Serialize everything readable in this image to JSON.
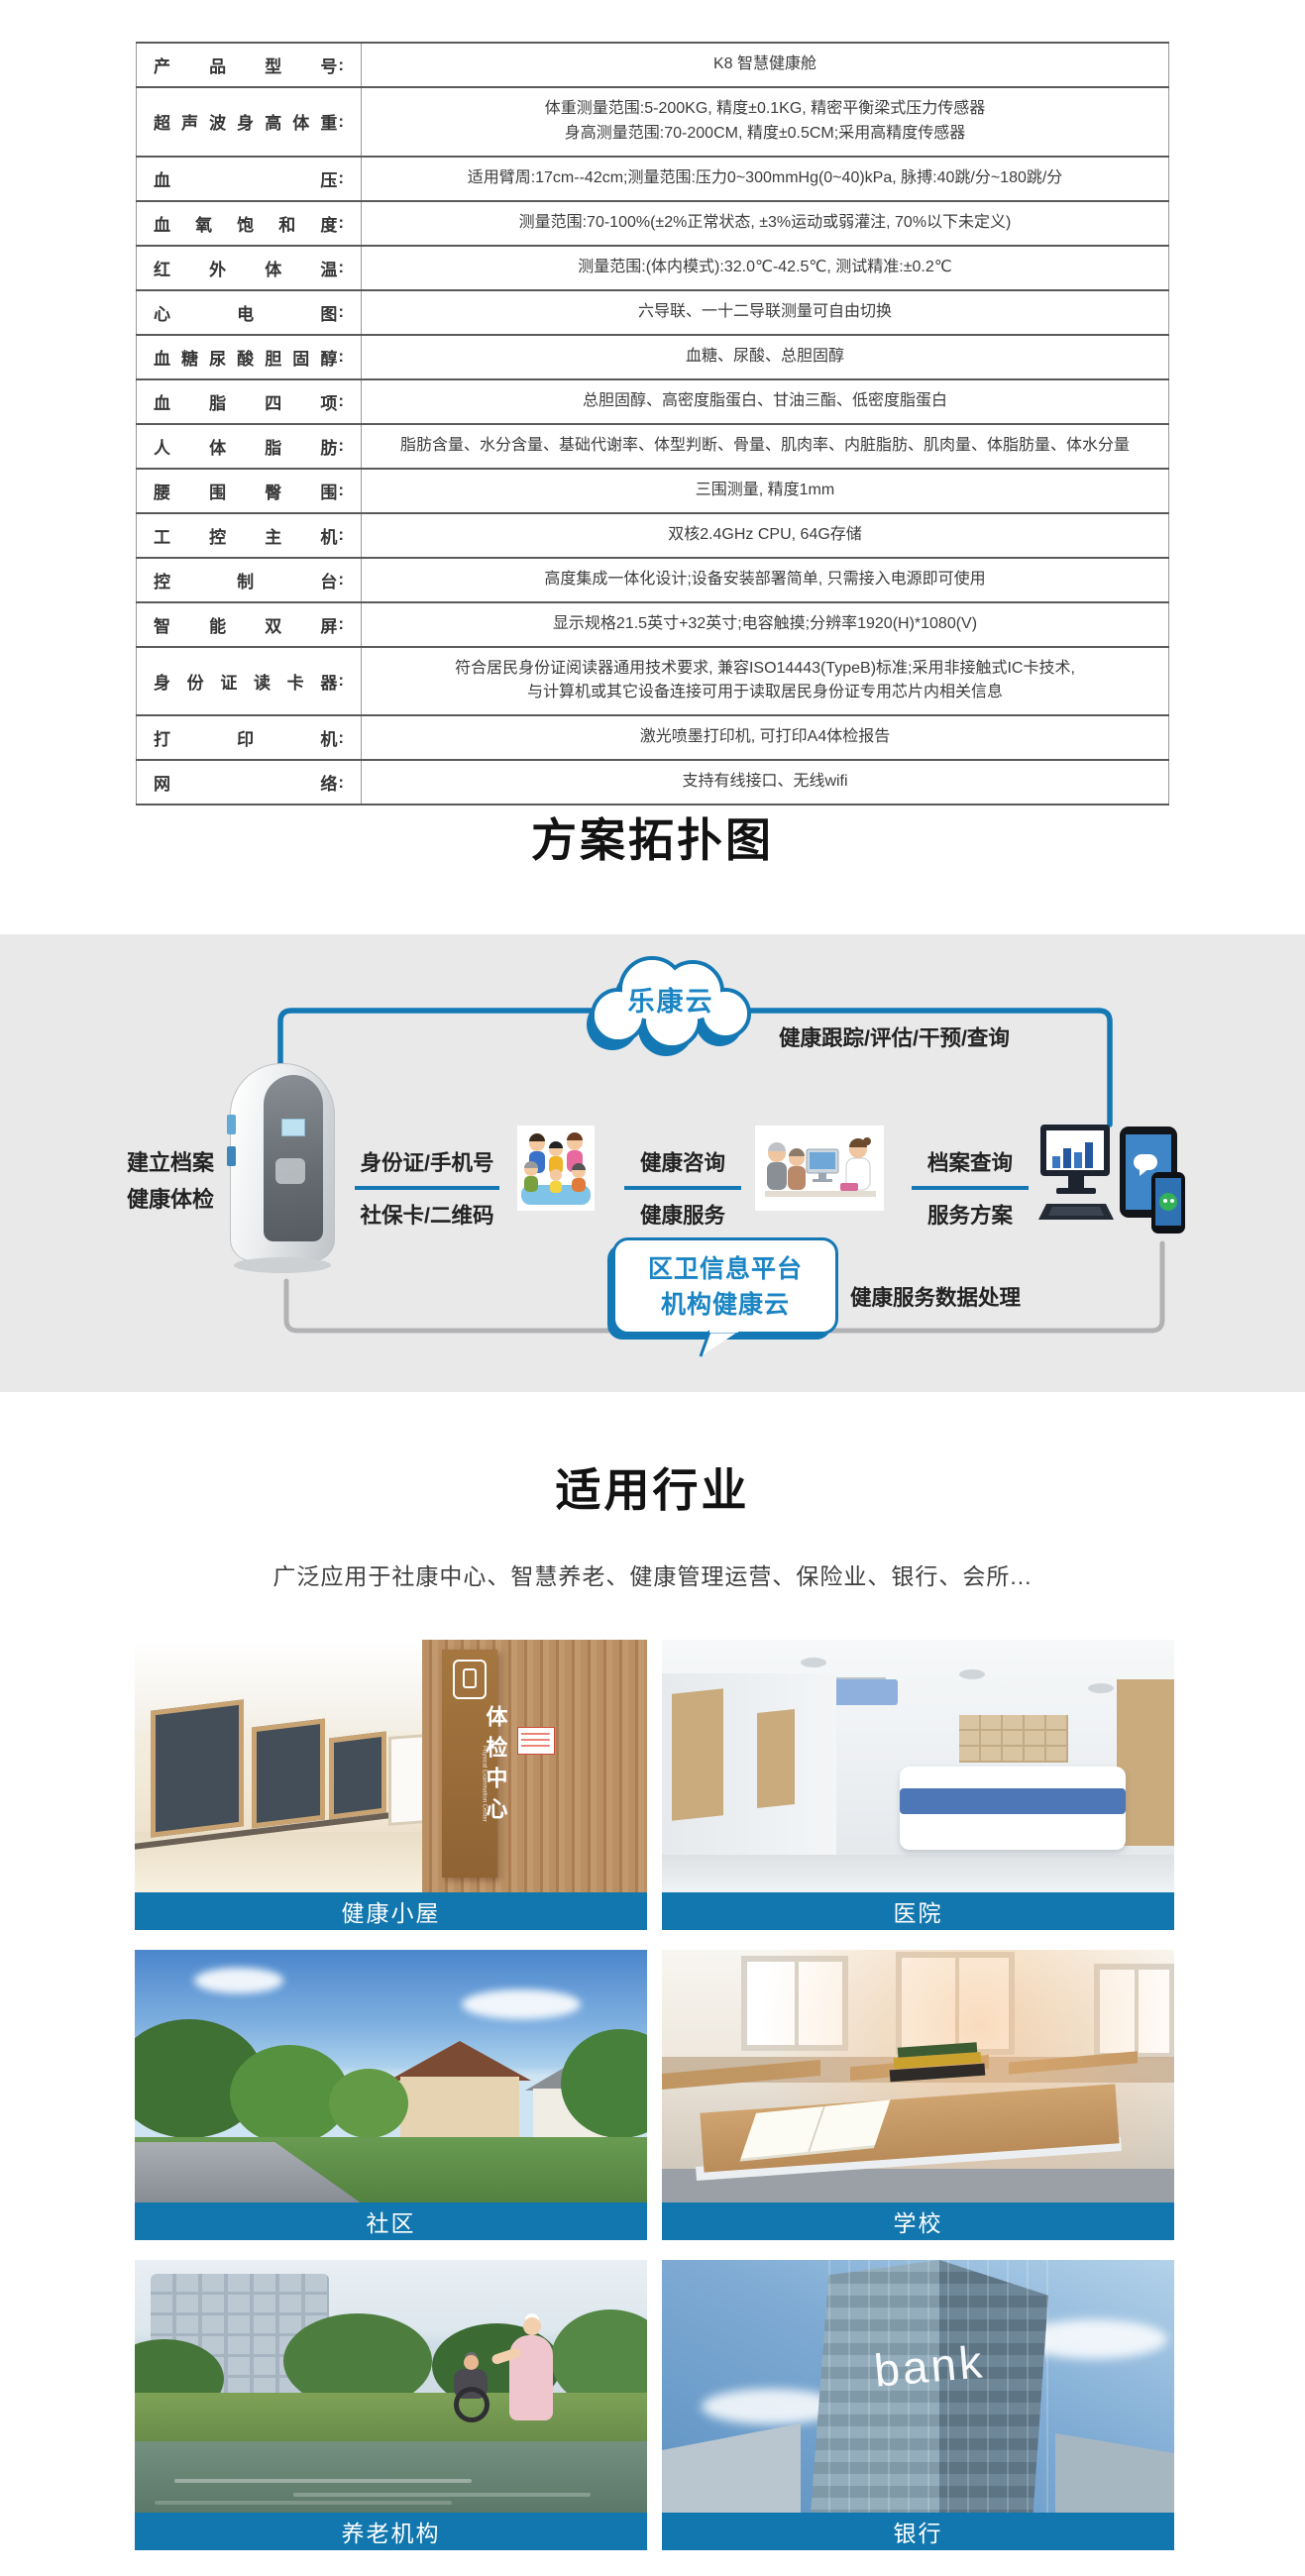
{
  "spec_table": {
    "colon": ":",
    "rows": [
      {
        "label": "产品型号",
        "value": "K8 智慧健康舱"
      },
      {
        "label": "超声波身高体重",
        "value": "体重测量范围:5-200KG, 精度±0.1KG, 精密平衡梁式压力传感器\n身高测量范围:70-200CM, 精度±0.5CM;采用高精度传感器"
      },
      {
        "label": "血压",
        "value": "适用臂周:17cm--42cm;测量范围:压力0~300mmHg(0~40)kPa, 脉搏:40跳/分~180跳/分"
      },
      {
        "label": "血氧饱和度",
        "value": "测量范围:70-100%(±2%正常状态, ±3%运动或弱灌注, 70%以下未定义)"
      },
      {
        "label": "红外体温",
        "value": "测量范围:(体内模式):32.0℃-42.5℃, 测试精准:±0.2℃"
      },
      {
        "label": "心电图",
        "value": "六导联、一十二导联测量可自由切换"
      },
      {
        "label": "血糖尿酸胆固醇",
        "value": "血糖、尿酸、总胆固醇"
      },
      {
        "label": "血脂四项",
        "value": "总胆固醇、高密度脂蛋白、甘油三酯、低密度脂蛋白"
      },
      {
        "label": "人体脂肪",
        "value": "脂肪含量、水分含量、基础代谢率、体型判断、骨量、肌肉率、内脏脂肪、肌肉量、体脂肪量、体水分量"
      },
      {
        "label": "腰围臀围",
        "value": "三围测量, 精度1mm"
      },
      {
        "label": "工控主机",
        "value": "双核2.4GHz CPU, 64G存储"
      },
      {
        "label": "控制台",
        "value": "高度集成一体化设计;设备安装部署简单, 只需接入电源即可使用"
      },
      {
        "label": "智能双屏",
        "value": "显示规格21.5英寸+32英寸;电容触摸;分辨率1920(H)*1080(V)"
      },
      {
        "label": "身份证读卡器",
        "value": "符合居民身份证阅读器通用技术要求, 兼容ISO14443(TypeB)标准;采用非接触式IC卡技术,\n与计算机或其它设备连接可用于读取居民身份证专用芯片内相关信息"
      },
      {
        "label": "打印机",
        "value": "激光喷墨打印机, 可打印A4体检报告"
      },
      {
        "label": "网络",
        "value": "支持有线接口、无线wifi"
      }
    ]
  },
  "topology": {
    "title": "方案拓扑图",
    "cloud_label": "乐康云",
    "cloud_tracking_label": "健康跟踪/评估/干预/查询",
    "device_label": "建立档案\n健康体检",
    "step1_top": "身份证/手机号",
    "step1_bottom": "社保卡/二维码",
    "step2_top": "健康咨询",
    "step2_bottom": "健康服务",
    "step3_top": "档案查询",
    "step3_bottom": "服务方案",
    "bubble_line1": "区卫信息平台",
    "bubble_line2": "机构健康云",
    "data_label": "健康服务数据处理",
    "colors": {
      "line_blue": "#1478b4",
      "line_gray": "#b2b2b4",
      "band_bg": "#e9e9ea",
      "text_blue": "#1b85c4"
    }
  },
  "industries": {
    "title": "适用行业",
    "subtitle": "广泛应用于社康中心、智慧养老、健康管理运营、保险业、银行、会所...",
    "label_bar_color": "#1177ae",
    "cards": [
      {
        "label": "健康小屋",
        "sign_text": "体检中心",
        "sign_subtext": "Physical Examination Center"
      },
      {
        "label": "医院"
      },
      {
        "label": "社区"
      },
      {
        "label": "学校"
      },
      {
        "label": "养老机构"
      },
      {
        "label": "银行",
        "overlay_text": "bank"
      }
    ]
  }
}
